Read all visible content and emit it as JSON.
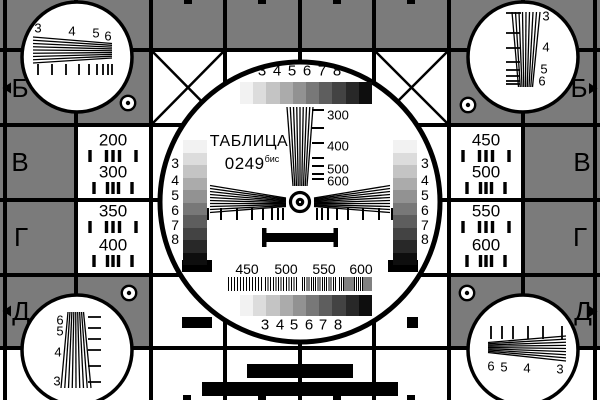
{
  "card": {
    "title": "ТАБЛИЦА",
    "code": "0249",
    "code_suffix": "бис"
  },
  "colors": {
    "background_gray": "#7b7b7b",
    "ink": "#000000",
    "paper": "#ffffff"
  },
  "grayscale": {
    "steps": [
      "#f2f2f2",
      "#dcdcdc",
      "#c4c4c4",
      "#ababab",
      "#929292",
      "#787878",
      "#5e5e5e",
      "#434343",
      "#282828",
      "#0e0e0e"
    ],
    "labels": [
      "3",
      "4",
      "5",
      "6",
      "7",
      "8"
    ]
  },
  "resolution": {
    "vertical_scale_labels": [
      "300",
      "400",
      "500",
      "600"
    ],
    "bottom_scale_labels": [
      "450",
      "500",
      "550",
      "600"
    ]
  },
  "line_count_cells": {
    "left_top": {
      "line1": "200",
      "line2": "300"
    },
    "left_bottom": {
      "line1": "350",
      "line2": "400"
    },
    "right_top": {
      "line1": "450",
      "line2": "500"
    },
    "right_bottom": {
      "line1": "550",
      "line2": "600"
    }
  },
  "edge_letters": {
    "left": [
      "Б",
      "В",
      "Г",
      "Д"
    ],
    "right": [
      "Б",
      "В",
      "Г",
      "Д"
    ]
  },
  "corner_wedge_labels": {
    "top_left": [
      "3",
      "4",
      "5",
      "6"
    ],
    "top_right": [
      "3",
      "4",
      "5",
      "6"
    ],
    "bottom_left": [
      "6",
      "5",
      "4",
      "3"
    ],
    "bottom_right": [
      "6",
      "5",
      "4",
      "3"
    ]
  }
}
